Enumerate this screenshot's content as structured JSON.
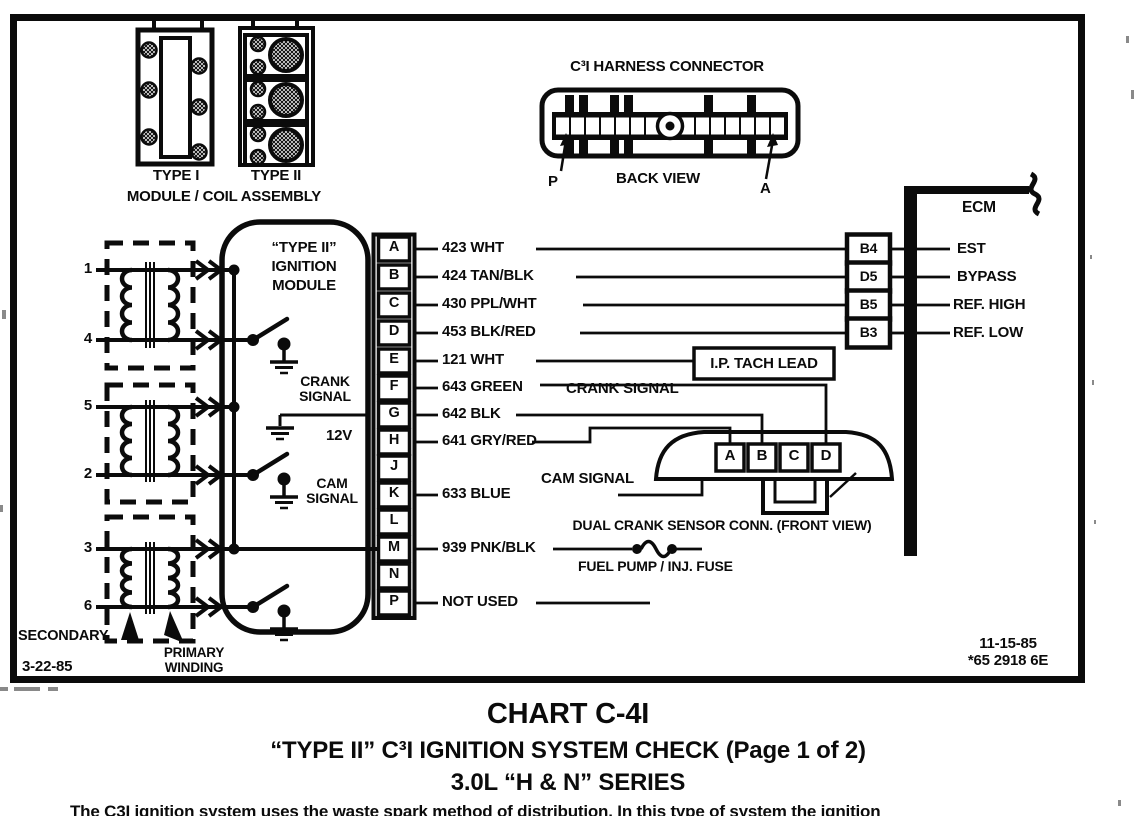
{
  "coil_assembly": {
    "type1": "TYPE I",
    "type2": "TYPE II",
    "caption": "MODULE / COIL ASSEMBLY"
  },
  "harness_connector": {
    "title": "C³I HARNESS CONNECTOR",
    "view": "BACK VIEW",
    "pin_first": "P",
    "pin_last": "A"
  },
  "ecm": {
    "label": "ECM",
    "pins": [
      {
        "pin": "B4",
        "signal": "EST"
      },
      {
        "pin": "D5",
        "signal": "BYPASS"
      },
      {
        "pin": "B5",
        "signal": "REF. HIGH"
      },
      {
        "pin": "B3",
        "signal": "REF. LOW"
      }
    ]
  },
  "coils": {
    "terminals": [
      "1",
      "4",
      "5",
      "2",
      "3",
      "6"
    ],
    "secondary": "SECONDARY",
    "primary": [
      "PRIMARY",
      "WINDING"
    ],
    "date": "3-22-85"
  },
  "module": {
    "title": [
      "“TYPE II”",
      "IGNITION",
      "MODULE"
    ],
    "crank": [
      "CRANK",
      "SIGNAL"
    ],
    "cam": [
      "CAM",
      "SIGNAL"
    ],
    "volts": "12V",
    "pins": [
      {
        "pin": "A",
        "wire": "423 WHT"
      },
      {
        "pin": "B",
        "wire": "424 TAN/BLK"
      },
      {
        "pin": "C",
        "wire": "430 PPL/WHT"
      },
      {
        "pin": "D",
        "wire": "453 BLK/RED"
      },
      {
        "pin": "E",
        "wire": "121 WHT"
      },
      {
        "pin": "F",
        "wire": "643 GREEN"
      },
      {
        "pin": "G",
        "wire": "642 BLK"
      },
      {
        "pin": "H",
        "wire": "641 GRY/RED"
      },
      {
        "pin": "J",
        "wire": ""
      },
      {
        "pin": "K",
        "wire": "633 BLUE"
      },
      {
        "pin": "L",
        "wire": ""
      },
      {
        "pin": "M",
        "wire": "939 PNK/BLK"
      },
      {
        "pin": "N",
        "wire": ""
      },
      {
        "pin": "P",
        "wire": "NOT USED"
      }
    ]
  },
  "annotations": {
    "ip_tach": "I.P. TACH LEAD",
    "crank_signal": "CRANK SIGNAL",
    "cam_signal": "CAM SIGNAL",
    "dual_crank": "DUAL CRANK SENSOR CONN. (FRONT VIEW)",
    "fuel_pump": "FUEL PUMP / INJ. FUSE"
  },
  "sensor_connector": {
    "pins": [
      "A",
      "B",
      "C",
      "D"
    ]
  },
  "revision": {
    "date": "11-15-85",
    "code": "*65 2918 6E"
  },
  "footer": {
    "title": "CHART C-4I",
    "subtitle": "“TYPE II” C³I IGNITION SYSTEM CHECK (Page 1 of 2)",
    "series": "3.0L “H & N” SERIES",
    "body": "The C3I ignition system uses the waste spark method of distribution. In this type of system the ignition"
  }
}
